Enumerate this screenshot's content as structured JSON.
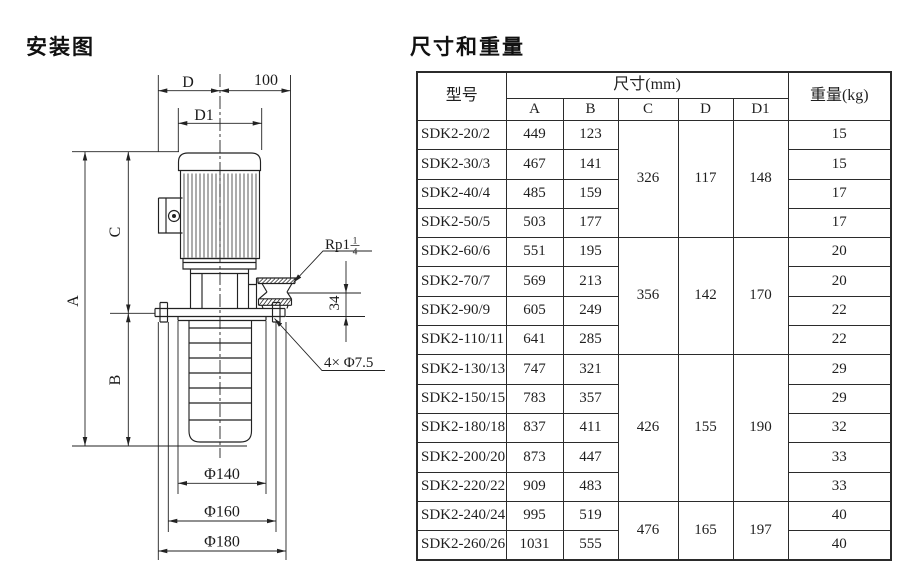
{
  "page": {
    "bg": "#ffffff",
    "ink": "#222222"
  },
  "diagram": {
    "title": "安装图",
    "labels": {
      "d": "D",
      "hundred": "100",
      "d1": "D1",
      "a": "A",
      "c": "C",
      "b": "B",
      "n34": "34",
      "rp": "Rp1",
      "frac_num": "1",
      "frac_den": "4",
      "holes": "4× Φ7.5",
      "dia140": "Φ140",
      "dia160": "Φ160",
      "dia180": "Φ180"
    }
  },
  "table": {
    "title": "尺寸和重量",
    "header": {
      "model": "型号",
      "dims_group": "尺寸(mm)",
      "dim_cols": [
        "A",
        "B",
        "C",
        "D",
        "D1"
      ],
      "weight": "重量(kg)"
    },
    "rows": [
      {
        "model": "SDK2-20/2",
        "a": "449",
        "b": "123",
        "weight": "15"
      },
      {
        "model": "SDK2-30/3",
        "a": "467",
        "b": "141",
        "weight": "15"
      },
      {
        "model": "SDK2-40/4",
        "a": "485",
        "b": "159",
        "weight": "17"
      },
      {
        "model": "SDK2-50/5",
        "a": "503",
        "b": "177",
        "weight": "17"
      },
      {
        "model": "SDK2-60/6",
        "a": "551",
        "b": "195",
        "weight": "20"
      },
      {
        "model": "SDK2-70/7",
        "a": "569",
        "b": "213",
        "weight": "20"
      },
      {
        "model": "SDK2-90/9",
        "a": "605",
        "b": "249",
        "weight": "22"
      },
      {
        "model": "SDK2-110/11",
        "a": "641",
        "b": "285",
        "weight": "22"
      },
      {
        "model": "SDK2-130/13",
        "a": "747",
        "b": "321",
        "weight": "29"
      },
      {
        "model": "SDK2-150/15",
        "a": "783",
        "b": "357",
        "weight": "29"
      },
      {
        "model": "SDK2-180/18",
        "a": "837",
        "b": "411",
        "weight": "32"
      },
      {
        "model": "SDK2-200/20",
        "a": "873",
        "b": "447",
        "weight": "33"
      },
      {
        "model": "SDK2-220/22",
        "a": "909",
        "b": "483",
        "weight": "33"
      },
      {
        "model": "SDK2-240/24",
        "a": "995",
        "b": "519",
        "weight": "40"
      },
      {
        "model": "SDK2-260/26",
        "a": "1031",
        "b": "555",
        "weight": "40"
      }
    ],
    "groups": [
      {
        "start": 0,
        "span": 4,
        "c": "326",
        "d": "117",
        "d1": "148"
      },
      {
        "start": 4,
        "span": 4,
        "c": "356",
        "d": "142",
        "d1": "170"
      },
      {
        "start": 8,
        "span": 5,
        "c": "426",
        "d": "155",
        "d1": "190"
      },
      {
        "start": 13,
        "span": 2,
        "c": "476",
        "d": "165",
        "d1": "197"
      }
    ]
  }
}
